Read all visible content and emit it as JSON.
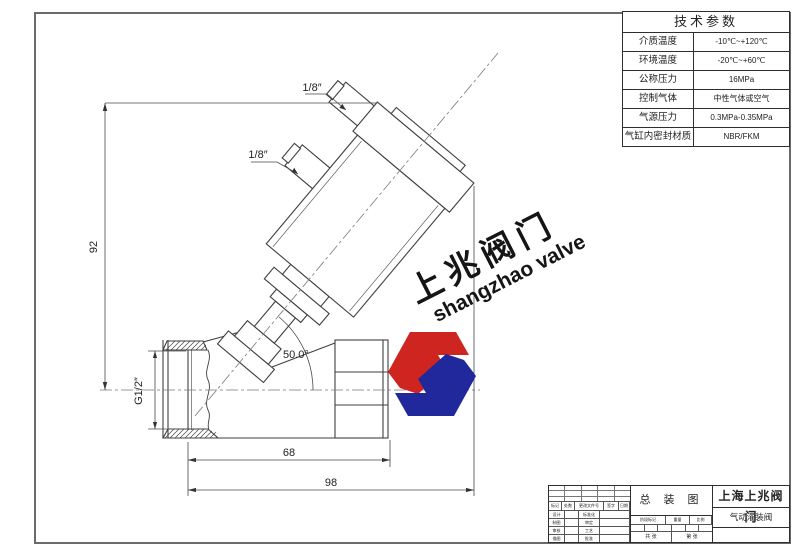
{
  "tech_table": {
    "title": "技术参数",
    "rows": [
      {
        "label": "介质温度",
        "value": "-10℃~+120℃"
      },
      {
        "label": "环境温度",
        "value": "-20℃~+60℃"
      },
      {
        "label": "公称压力",
        "value": "16MPa"
      },
      {
        "label": "控制气体",
        "value": "中性气体或空气"
      },
      {
        "label": "气源压力",
        "value": "0.3MPa-0.35MPa"
      },
      {
        "label": "气缸内密封材质",
        "value": "NBR/FKM"
      }
    ]
  },
  "drawing": {
    "dims": {
      "height": "92",
      "body_width": "68",
      "total_width": "98",
      "angle": "50.0°",
      "port_thread": "G1/2″",
      "pilot_top": "1/8″",
      "pilot_side": "1/8″"
    }
  },
  "watermark": {
    "cn": "上兆阀门",
    "en": "shangzhao valve",
    "colors": {
      "red": "#cf2520",
      "blue": "#20289b"
    }
  },
  "title_block": {
    "drawing_type": "总 装 图",
    "company": "上海上兆阀门",
    "product": "气动灌装阀",
    "revision_header": [
      "标记",
      "处数",
      "更改文件号",
      "签字",
      "日期"
    ],
    "sign_rows": [
      [
        "设计",
        "标准化"
      ],
      [
        "制图",
        "审定"
      ],
      [
        "审核",
        "工艺"
      ],
      [
        "描图",
        "批准"
      ]
    ],
    "stage_header": [
      "阶段标记",
      "重量",
      "比例"
    ],
    "sheet_info": [
      "共 张",
      "第 张"
    ]
  }
}
